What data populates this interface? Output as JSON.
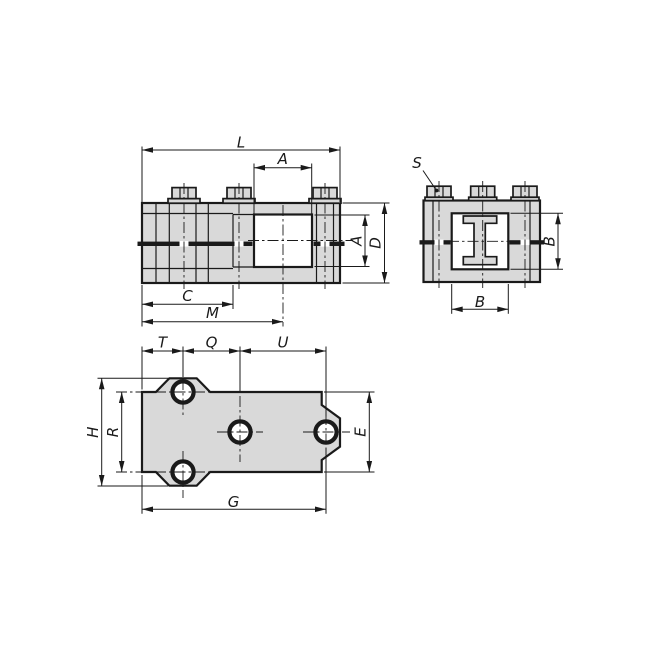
{
  "drawing": {
    "colors": {
      "part_fill": "#d9d9d9",
      "line": "#1a1a1a",
      "background": "#ffffff"
    },
    "views": {
      "front": {
        "dims": {
          "L": "L",
          "A_width": "A",
          "A_height": "A",
          "D": "D",
          "C": "C",
          "M": "M"
        }
      },
      "side": {
        "dims": {
          "S": "S",
          "B_width": "B",
          "B_height": "B"
        }
      },
      "plan": {
        "dims": {
          "T": "T",
          "Q": "Q",
          "U": "U",
          "H": "H",
          "R": "R",
          "E": "E",
          "G": "G"
        }
      }
    }
  }
}
